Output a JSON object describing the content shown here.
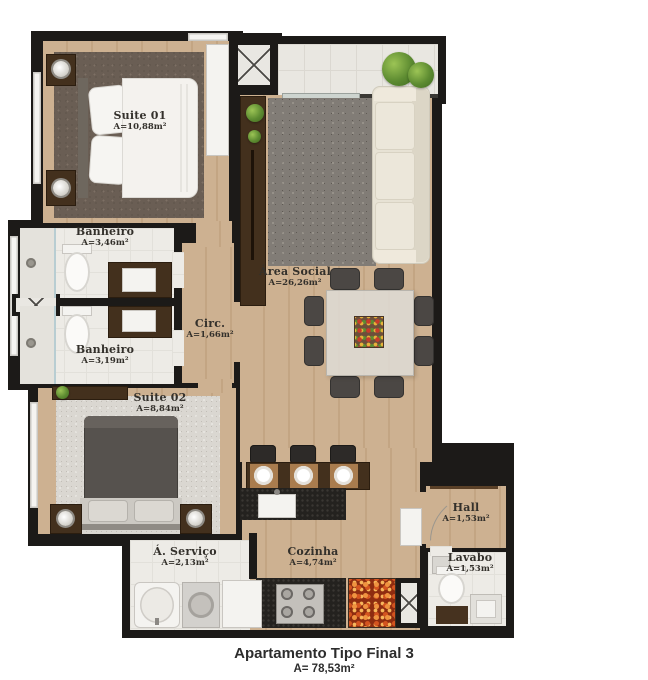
{
  "title": {
    "name": "Apartamento Tipo Final 3",
    "area": "A= 78,53m²"
  },
  "rooms": {
    "suite01": {
      "name": "Suite 01",
      "area": "A=10,88m²"
    },
    "banheiro1": {
      "name": "Banheiro",
      "area": "A=3,46m²"
    },
    "banheiro2": {
      "name": "Banheiro",
      "area": "A=3,19m²"
    },
    "circ": {
      "name": "Circ.",
      "area": "A=1,66m²"
    },
    "area_social": {
      "name": "Área Social",
      "area": "A=26,26m²"
    },
    "suite02": {
      "name": "Suite 02",
      "area": "A=8,84m²"
    },
    "servico": {
      "name": "Á. Serviço",
      "area": "A=2,13m²"
    },
    "cozinha": {
      "name": "Cozinha",
      "area": "A=4,74m²"
    },
    "hall": {
      "name": "Hall",
      "area": "A=1,53m²"
    },
    "lavabo": {
      "name": "Lavabo",
      "area": "A=1,53m²"
    }
  },
  "colors": {
    "wall": "#1c1a18",
    "wood_floor": "#c9ac8a",
    "tile_floor": "#edebe6",
    "dark_furniture": "#43301d",
    "label_text": "#33302b",
    "plant_green": "#5d8b31",
    "flower_orange": "#d4541f"
  }
}
